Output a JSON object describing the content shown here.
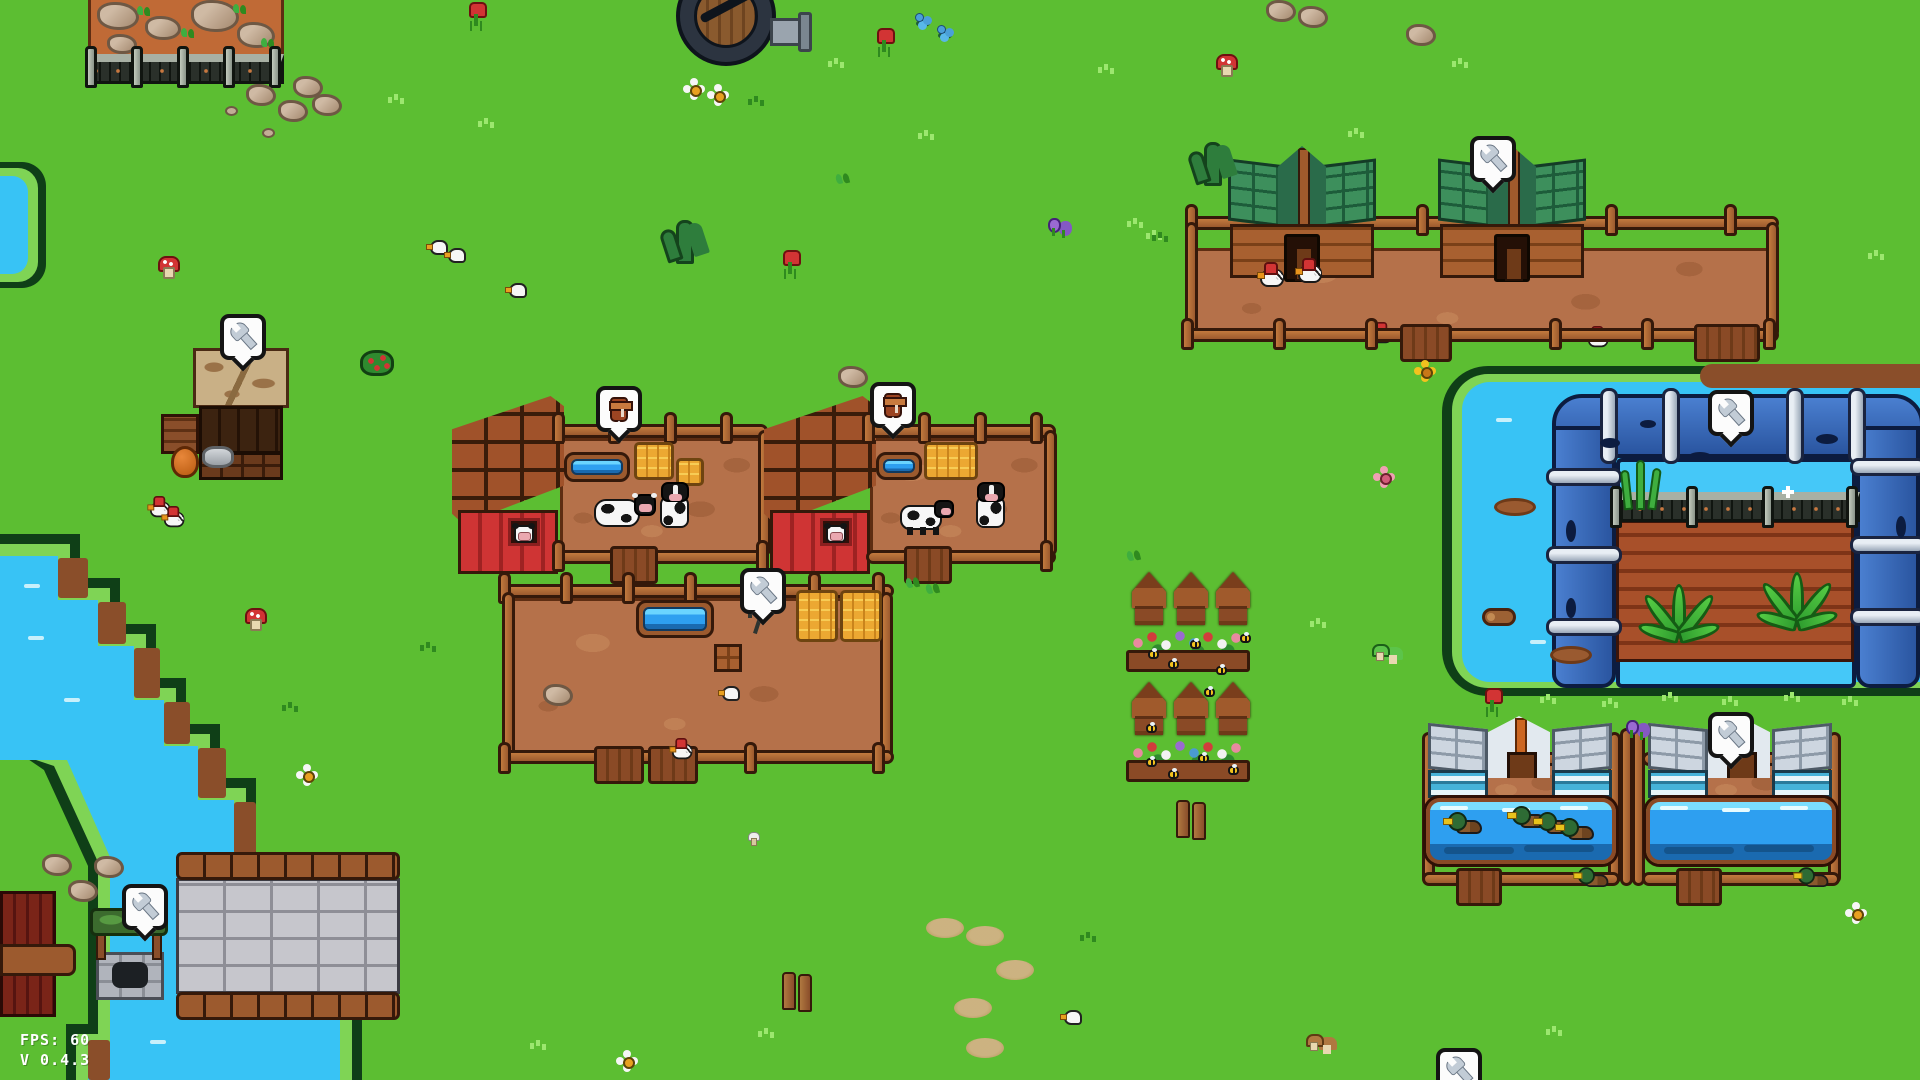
{
  "hud": {
    "fps": "FPS: 60",
    "version": "V 0.4.3"
  },
  "palette": {
    "grass": "#5cbe32",
    "grass_light": "#9ce76f",
    "grass_dark": "#2f8a1f",
    "water": "#38c3f5",
    "bank": "#7fd455",
    "bank_outline": "#0f3f17",
    "wood": "#9c5a2e",
    "wood_dark": "#35190a",
    "dirt": "#b5714a",
    "barn_red": "#cf3434",
    "barn_roof": "#a0522a",
    "coop_roof_green": "#3d8f5c",
    "duck_roof_silver": "#cdd6e0",
    "duck_wall_teal": "#46b2d8",
    "pipe_blue": "#3468b8",
    "hay": "#eca832",
    "soil": "#a8502a",
    "bubble_bg": "#fcfcfc",
    "bubble_border": "#141414",
    "bridge_stone": "#c6c6cc",
    "quarry_dirt": "#c06a36",
    "metal_fence": "#2a302a"
  },
  "icons": {
    "wrench": "upgrade-wrench-icon",
    "milk": "milk-can-icon"
  },
  "bubbles": [
    {
      "icon": "wrench",
      "x": 220,
      "y": 314
    },
    {
      "icon": "wrench",
      "x": 122,
      "y": 884
    },
    {
      "icon": "wrench",
      "x": 740,
      "y": 568
    },
    {
      "icon": "wrench",
      "x": 1470,
      "y": 136
    },
    {
      "icon": "wrench",
      "x": 1708,
      "y": 390
    },
    {
      "icon": "wrench",
      "x": 1708,
      "y": 712
    },
    {
      "icon": "wrench",
      "x": 1436,
      "y": 1048
    },
    {
      "icon": "milk",
      "x": 596,
      "y": 386
    },
    {
      "icon": "milk",
      "x": 870,
      "y": 382
    }
  ],
  "sprites": [
    {
      "t": "gl",
      "x": 388,
      "y": 94
    },
    {
      "t": "gl",
      "x": 478,
      "y": 118
    },
    {
      "t": "gl",
      "x": 828,
      "y": 58
    },
    {
      "t": "gl",
      "x": 918,
      "y": 130
    },
    {
      "t": "gl",
      "x": 1098,
      "y": 64
    },
    {
      "t": "gl",
      "x": 1127,
      "y": 218
    },
    {
      "t": "gl",
      "x": 1146,
      "y": 230
    },
    {
      "t": "gl",
      "x": 1348,
      "y": 128
    },
    {
      "t": "gl",
      "x": 1452,
      "y": 58
    },
    {
      "t": "gl",
      "x": 1310,
      "y": 618
    },
    {
      "t": "gl",
      "x": 530,
      "y": 1040
    },
    {
      "t": "gl",
      "x": 758,
      "y": 1028
    },
    {
      "t": "gl",
      "x": 1546,
      "y": 1026
    },
    {
      "t": "gl",
      "x": 1868,
      "y": 250
    },
    {
      "t": "gl",
      "x": 1540,
      "y": 694
    },
    {
      "t": "gl",
      "x": 1602,
      "y": 698
    },
    {
      "t": "gl",
      "x": 1662,
      "y": 692
    },
    {
      "t": "gl",
      "x": 1722,
      "y": 696
    },
    {
      "t": "gl",
      "x": 1784,
      "y": 692
    },
    {
      "t": "gl",
      "x": 1842,
      "y": 696
    },
    {
      "t": "gd",
      "x": 748,
      "y": 96
    },
    {
      "t": "gd",
      "x": 420,
      "y": 642
    },
    {
      "t": "gd",
      "x": 282,
      "y": 702
    },
    {
      "t": "gd",
      "x": 1152,
      "y": 232
    },
    {
      "t": "gd",
      "x": 1080,
      "y": 932
    },
    {
      "t": "plant",
      "x": 664,
      "y": 220
    },
    {
      "t": "plant",
      "x": 1192,
      "y": 142
    },
    {
      "t": "fr",
      "x": 468,
      "y": 2
    },
    {
      "t": "fr",
      "x": 876,
      "y": 28
    },
    {
      "t": "fr",
      "x": 782,
      "y": 250
    },
    {
      "t": "fr",
      "x": 1484,
      "y": 688
    },
    {
      "t": "fw",
      "x": 684,
      "y": 80
    },
    {
      "t": "fw",
      "x": 708,
      "y": 86
    },
    {
      "t": "fw",
      "x": 297,
      "y": 766
    },
    {
      "t": "fw",
      "x": 1846,
      "y": 904
    },
    {
      "t": "fw",
      "x": 617,
      "y": 1052
    },
    {
      "t": "fy",
      "x": 1415,
      "y": 362
    },
    {
      "t": "fp",
      "x": 1374,
      "y": 468
    },
    {
      "t": "fpu",
      "x": 1048,
      "y": 216
    },
    {
      "t": "fpu",
      "x": 1626,
      "y": 718
    },
    {
      "t": "fb",
      "x": 914,
      "y": 12
    },
    {
      "t": "fb",
      "x": 936,
      "y": 24
    },
    {
      "t": "bush",
      "x": 360,
      "y": 350
    },
    {
      "t": "mr",
      "x": 158,
      "y": 256
    },
    {
      "t": "mr",
      "x": 1216,
      "y": 54
    },
    {
      "t": "mr",
      "x": 245,
      "y": 608
    },
    {
      "t": "mb",
      "x": 1306,
      "y": 1034
    },
    {
      "t": "mg",
      "x": 1372,
      "y": 644
    },
    {
      "t": "mw",
      "x": 748,
      "y": 832
    },
    {
      "t": "sprout",
      "x": 836,
      "y": 174
    },
    {
      "t": "sprout",
      "x": 1127,
      "y": 551
    },
    {
      "t": "sprout",
      "x": 906,
      "y": 578
    },
    {
      "t": "sprout",
      "x": 926,
      "y": 584
    },
    {
      "t": "rock",
      "x": 246,
      "y": 84
    },
    {
      "t": "rock",
      "x": 278,
      "y": 100
    },
    {
      "t": "rock",
      "x": 293,
      "y": 76
    },
    {
      "t": "rock",
      "x": 838,
      "y": 366
    },
    {
      "t": "rock",
      "x": 1406,
      "y": 24
    },
    {
      "t": "rock",
      "x": 1266,
      "y": 0
    },
    {
      "t": "rock",
      "x": 1298,
      "y": 6
    },
    {
      "t": "rock",
      "x": 42,
      "y": 854
    },
    {
      "t": "rock",
      "x": 68,
      "y": 880
    },
    {
      "t": "rock",
      "x": 94,
      "y": 856
    },
    {
      "t": "rock",
      "x": 312,
      "y": 94
    },
    {
      "t": "rock",
      "x": 543,
      "y": 684
    },
    {
      "t": "peb",
      "x": 262,
      "y": 128
    },
    {
      "t": "peb",
      "x": 225,
      "y": 106
    },
    {
      "t": "log",
      "x": 1482,
      "y": 608
    },
    {
      "t": "mud",
      "x": 1550,
      "y": 646
    },
    {
      "t": "mud",
      "x": 1494,
      "y": 498
    },
    {
      "t": "bird",
      "x": 426,
      "y": 240
    },
    {
      "t": "bird",
      "x": 444,
      "y": 248
    },
    {
      "t": "bird",
      "x": 505,
      "y": 283
    },
    {
      "t": "bird",
      "x": 718,
      "y": 686
    },
    {
      "t": "bird",
      "x": 1060,
      "y": 1010
    },
    {
      "t": "patch",
      "x": 926,
      "y": 918
    },
    {
      "t": "patch",
      "x": 966,
      "y": 926
    },
    {
      "t": "patch",
      "x": 996,
      "y": 960
    },
    {
      "t": "patch",
      "x": 954,
      "y": 998
    },
    {
      "t": "patch",
      "x": 966,
      "y": 1038
    },
    {
      "t": "posts",
      "x": 1176,
      "y": 800
    },
    {
      "t": "posts",
      "x": 782,
      "y": 972
    },
    {
      "t": "spark",
      "x": 1782,
      "y": 486
    },
    {
      "t": "bee",
      "x": 1148,
      "y": 650
    },
    {
      "t": "bee",
      "x": 1168,
      "y": 660
    },
    {
      "t": "bee",
      "x": 1190,
      "y": 640
    },
    {
      "t": "bee",
      "x": 1216,
      "y": 666
    },
    {
      "t": "bee",
      "x": 1240,
      "y": 634
    },
    {
      "t": "bee",
      "x": 1146,
      "y": 758
    },
    {
      "t": "bee",
      "x": 1168,
      "y": 770
    },
    {
      "t": "bee",
      "x": 1198,
      "y": 754
    },
    {
      "t": "bee",
      "x": 1228,
      "y": 766
    },
    {
      "t": "bee",
      "x": 1146,
      "y": 724
    },
    {
      "t": "bee",
      "x": 1204,
      "y": 688
    }
  ]
}
